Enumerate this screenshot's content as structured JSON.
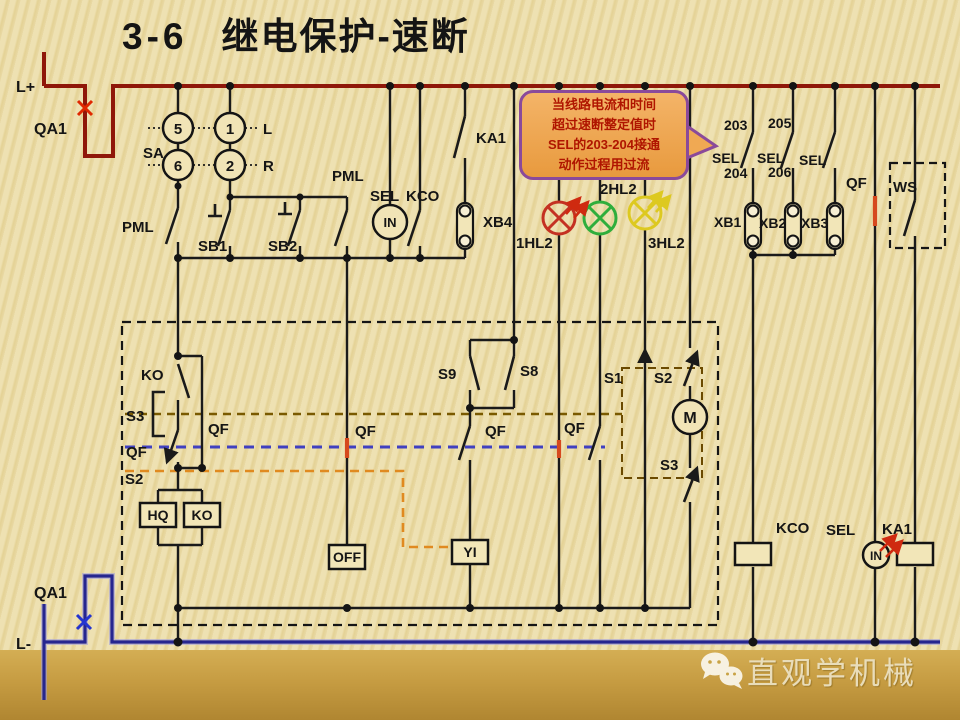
{
  "title": {
    "number": "3-6",
    "text": "继电保护-速断"
  },
  "callout": {
    "lines": [
      "当线路电流和时间",
      "超过速断整定值时",
      "SEL的203-204接通",
      "动作过程用过流"
    ],
    "fill": "#f0a953",
    "border": "#8a4a9a",
    "text_color": "#b01500"
  },
  "watermark": {
    "text": "直观学机械",
    "icon": "wechat-icon"
  },
  "rails": {
    "positive": "L+",
    "negative": "L-",
    "breaker": "QA1"
  },
  "colors": {
    "bus_positive": "#8f1709",
    "bus_negative": "#26268f",
    "wire": "#1a1a1a",
    "lamp_red": "#c43122",
    "lamp_green": "#2fae3c",
    "lamp_yellow": "#ddc920",
    "highlight": "#d6491e",
    "dashed_brown": "#7a5a00",
    "dashed_blue": "#4040c0",
    "dashed_orange": "#e08a20",
    "background": "#ecdfae",
    "band": "#c9a345"
  },
  "lamps": [
    {
      "id": "1HL2",
      "color": "#c43122"
    },
    {
      "id": "2HL2",
      "color": "#2fae3c"
    },
    {
      "id": "3HL2",
      "color": "#ddc920"
    }
  ],
  "schematic": {
    "labels": [
      {
        "id": "l-plus",
        "t": "L+",
        "x": 16,
        "y": 92,
        "s": 16
      },
      {
        "id": "qa1-top",
        "t": "QA1",
        "x": 34,
        "y": 134,
        "s": 16
      },
      {
        "id": "sa",
        "t": "SA",
        "x": 143,
        "y": 158,
        "s": 15
      },
      {
        "id": "sa-5",
        "t": "5",
        "x": 178,
        "y": 134,
        "a": "middle",
        "s": 15
      },
      {
        "id": "sa-1",
        "t": "1",
        "x": 230,
        "y": 134,
        "a": "middle",
        "s": 15
      },
      {
        "id": "sa-6",
        "t": "6",
        "x": 178,
        "y": 171,
        "a": "middle",
        "s": 15
      },
      {
        "id": "sa-2",
        "t": "2",
        "x": 230,
        "y": 171,
        "a": "middle",
        "s": 15
      },
      {
        "id": "sa-l",
        "t": "L",
        "x": 263,
        "y": 134,
        "s": 15
      },
      {
        "id": "sa-r",
        "t": "R",
        "x": 263,
        "y": 171,
        "s": 15
      },
      {
        "id": "pml-left",
        "t": "PML",
        "x": 122,
        "y": 232,
        "s": 15
      },
      {
        "id": "sb1",
        "t": "SB1",
        "x": 198,
        "y": 251,
        "s": 15
      },
      {
        "id": "sb2",
        "t": "SB2",
        "x": 268,
        "y": 251,
        "s": 15
      },
      {
        "id": "pml-mid",
        "t": "PML",
        "x": 332,
        "y": 181,
        "s": 15
      },
      {
        "id": "sel-top",
        "t": "SEL",
        "x": 370,
        "y": 201,
        "s": 15
      },
      {
        "id": "kco-top",
        "t": "KCO",
        "x": 406,
        "y": 201,
        "s": 15
      },
      {
        "id": "in-left",
        "t": "IN",
        "x": 390,
        "y": 227,
        "a": "middle",
        "s": 13
      },
      {
        "id": "ka1-top",
        "t": "KA1",
        "x": 476,
        "y": 143,
        "s": 15
      },
      {
        "id": "xb4",
        "t": "XB4",
        "x": 483,
        "y": 227,
        "s": 15
      },
      {
        "id": "hl1",
        "t": "1HL2",
        "x": 516,
        "y": 248,
        "s": 15
      },
      {
        "id": "hl2",
        "t": "2HL2",
        "x": 600,
        "y": 194,
        "s": 15
      },
      {
        "id": "hl3",
        "t": "3HL2",
        "x": 648,
        "y": 248,
        "s": 15
      },
      {
        "id": "n203",
        "t": "203",
        "x": 724,
        "y": 130,
        "s": 14
      },
      {
        "id": "n205",
        "t": "205",
        "x": 768,
        "y": 128,
        "s": 14
      },
      {
        "id": "sel-1",
        "t": "SEL",
        "x": 712,
        "y": 163,
        "s": 14
      },
      {
        "id": "sel-2",
        "t": "SEL",
        "x": 757,
        "y": 163,
        "s": 14
      },
      {
        "id": "sel-3",
        "t": "SEL",
        "x": 799,
        "y": 165,
        "s": 14
      },
      {
        "id": "n204",
        "t": "204",
        "x": 724,
        "y": 178,
        "s": 14
      },
      {
        "id": "n206",
        "t": "206",
        "x": 768,
        "y": 177,
        "s": 14
      },
      {
        "id": "xb1",
        "t": "XB1",
        "x": 714,
        "y": 227,
        "s": 14
      },
      {
        "id": "xb2",
        "t": "XB2",
        "x": 759,
        "y": 228,
        "s": 14
      },
      {
        "id": "xb3",
        "t": "XB3",
        "x": 801,
        "y": 228,
        "s": 14
      },
      {
        "id": "qf-top-right",
        "t": "QF",
        "x": 846,
        "y": 188,
        "s": 15
      },
      {
        "id": "ws",
        "t": "WS",
        "x": 893,
        "y": 192,
        "s": 15
      },
      {
        "id": "ko-contact",
        "t": "KO",
        "x": 141,
        "y": 380,
        "s": 15
      },
      {
        "id": "s3-left",
        "t": "S3",
        "x": 126,
        "y": 421,
        "s": 15
      },
      {
        "id": "qf-branch",
        "t": "QF",
        "x": 208,
        "y": 434,
        "s": 15
      },
      {
        "id": "qf-left",
        "t": "QF",
        "x": 126,
        "y": 457,
        "s": 15
      },
      {
        "id": "s2-left",
        "t": "S2",
        "x": 125,
        "y": 484,
        "s": 15
      },
      {
        "id": "hq-box",
        "t": "HQ",
        "x": 158,
        "y": 520,
        "a": "middle",
        "s": 14
      },
      {
        "id": "ko-box",
        "t": "KO",
        "x": 202,
        "y": 520,
        "a": "middle",
        "s": 14
      },
      {
        "id": "off-box",
        "t": "OFF",
        "x": 347,
        "y": 562,
        "a": "middle",
        "s": 14
      },
      {
        "id": "yi-box",
        "t": "YI",
        "x": 470,
        "y": 557,
        "a": "middle",
        "s": 14
      },
      {
        "id": "qf-347",
        "t": "QF",
        "x": 355,
        "y": 436,
        "s": 15
      },
      {
        "id": "s9",
        "t": "S9",
        "x": 438,
        "y": 379,
        "s": 15
      },
      {
        "id": "s8",
        "t": "S8",
        "x": 520,
        "y": 376,
        "s": 15
      },
      {
        "id": "qf-470",
        "t": "QF",
        "x": 485,
        "y": 436,
        "s": 15
      },
      {
        "id": "qf-600",
        "t": "QF",
        "x": 564,
        "y": 433,
        "s": 15
      },
      {
        "id": "s1",
        "t": "S1",
        "x": 604,
        "y": 383,
        "s": 15
      },
      {
        "id": "s2-right",
        "t": "S2",
        "x": 654,
        "y": 383,
        "s": 15
      },
      {
        "id": "m-motor",
        "t": "M",
        "x": 690,
        "y": 423,
        "a": "middle",
        "s": 16
      },
      {
        "id": "s3-right",
        "t": "S3",
        "x": 660,
        "y": 470,
        "s": 15
      },
      {
        "id": "kco-coil",
        "t": "KCO",
        "x": 776,
        "y": 533,
        "s": 15
      },
      {
        "id": "sel-coil",
        "t": "SEL",
        "x": 826,
        "y": 535,
        "s": 15
      },
      {
        "id": "ka1-coil",
        "t": "KA1",
        "x": 882,
        "y": 534,
        "s": 15
      },
      {
        "id": "in-right",
        "t": "IN",
        "x": 876,
        "y": 560,
        "a": "middle",
        "s": 12
      },
      {
        "id": "qa1-bottom",
        "t": "QA1",
        "x": 34,
        "y": 598,
        "s": 16
      },
      {
        "id": "l-minus",
        "t": "L-",
        "x": 16,
        "y": 649,
        "s": 16
      }
    ]
  }
}
